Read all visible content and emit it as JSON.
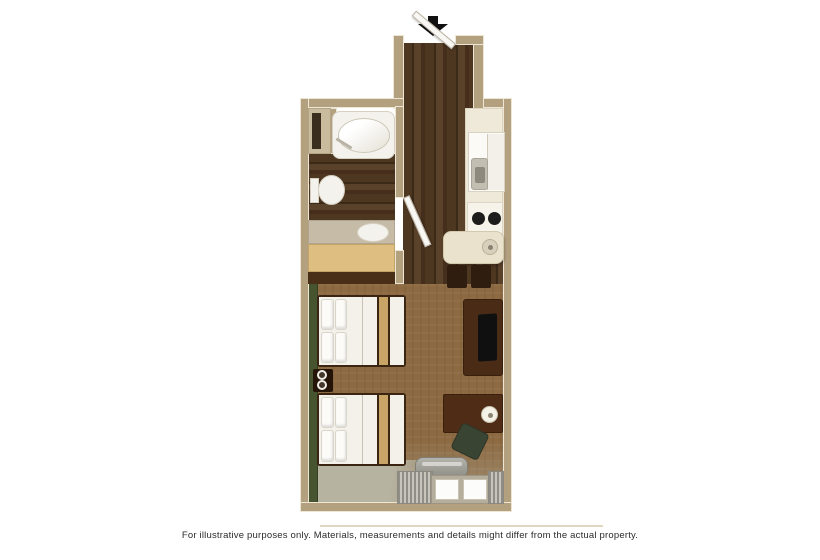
{
  "caption": {
    "text": "For illustrative purposes only.  Materials, measurements and details might differ from the actual property."
  },
  "entrance": {
    "icon": "entrance-arrow-down-icon"
  },
  "floorplan": {
    "type": "studio-suite-floor-plan",
    "rooms": [
      "entry-hallway",
      "bathroom",
      "kitchenette",
      "dining-nook",
      "bedroom-living-area"
    ],
    "bathroom_items": [
      "linen-closet",
      "bathtub",
      "toilet",
      "vanity-counter-sink",
      "vanity-cabinet"
    ],
    "kitchen_items": [
      "kitchen-counter",
      "refrigerator",
      "kitchen-sink-faucet",
      "two-burner-stove",
      "dining-table-with-bowl",
      "dining-chair",
      "dining-chair"
    ],
    "bedroom_items": [
      "double-bed",
      "double-bed",
      "nightstand-with-lamps",
      "tv-stand-with-tv",
      "desk-with-lamp",
      "desk-chair",
      "ac-unit",
      "window-with-curtains"
    ],
    "doors": [
      "entry-door-open",
      "bathroom-door-open"
    ]
  },
  "colors": {
    "wall_fill": "#b3a07f",
    "wall_edge": "#eee6d4",
    "carpet": "#8d6a42",
    "floor_sage": "#b6b3a1",
    "accent_wall": "#475430",
    "fixture_white": "#f4f2ec",
    "counter_cream": "#efe9da",
    "vanity_wood": "#dfbe82",
    "table_cream": "#eae2cc",
    "furniture_dark": "#4a2b15",
    "chair_dark": "#2f1d10",
    "tv_black": "#101010",
    "desk_chair_green": "#3a4433",
    "stripe_tan": "#c8a567",
    "ac_gray": "#9a988f",
    "arrow_black": "#111111",
    "caption_color": "#2b2b2b",
    "divider": "#d9cdb1",
    "background": "#ffffff"
  }
}
